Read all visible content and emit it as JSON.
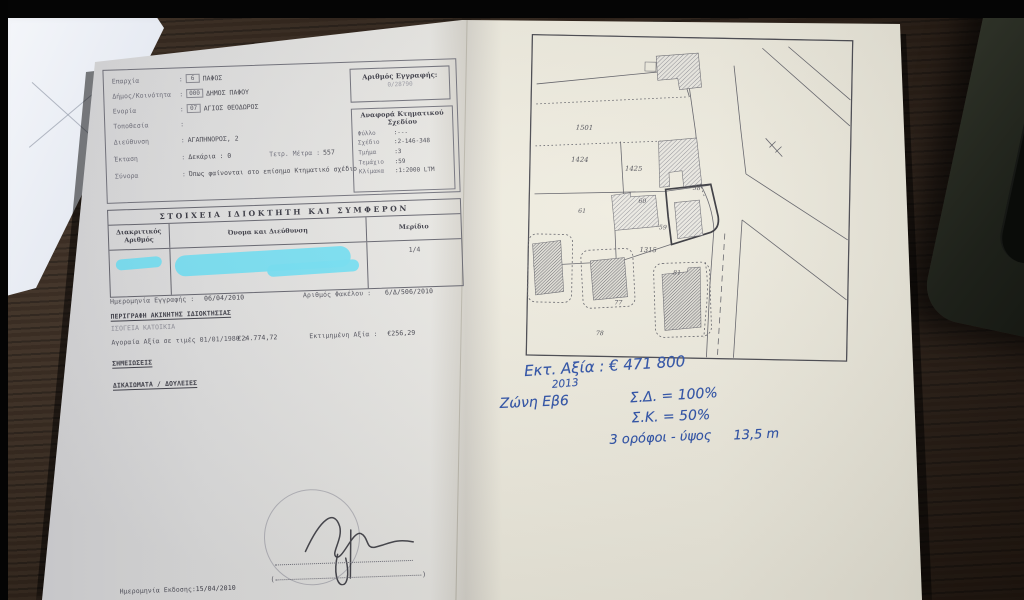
{
  "form": {
    "fields": [
      {
        "label": "Επαρχία",
        "sep": ":",
        "code": "6",
        "value": "ΠΑΦΟΣ"
      },
      {
        "label": "Δήμος/Κοινότητα",
        "sep": ":",
        "code": "000",
        "value": "ΔΗΜΟΣ ΠΑΦΟΥ"
      },
      {
        "label": "Ενορία",
        "sep": ":",
        "code": "07",
        "value": "ΑΓΙΟΣ ΘΕΟΔΩΡΟΣ"
      },
      {
        "label": "Τοποθεσία",
        "sep": ":",
        "code": "",
        "value": ""
      },
      {
        "label": "Διεύθυνση",
        "sep": ":",
        "code": "",
        "value": "ΑΓΑΠΗΝΟΡΟΣ, 2"
      },
      {
        "label": "Έκταση",
        "sep": ":",
        "code": "",
        "value": "Δεκάρια : 0",
        "extra_label": "Τετρ. Μέτρα :",
        "extra_value": "557"
      },
      {
        "label": "Σύνορα",
        "sep": ":",
        "code": "",
        "value": "Όπως φαίνονται στο επίσημο Κτηματικό σχέδιο"
      }
    ],
    "registration_box": {
      "title": "Αριθμός Εγγραφής:",
      "number": "0/28790"
    },
    "plan_box": {
      "title": "Αναφορά Κτηματικού Σχεδίου",
      "rows": [
        {
          "label": "Φύλλο",
          "value": ":---"
        },
        {
          "label": "Σχέδιο",
          "value": ":2-146-348"
        },
        {
          "label": "Τμήμα",
          "value": ":3"
        },
        {
          "label": "Τεμάχιο",
          "value": ":59"
        },
        {
          "label": "Κλίμακα",
          "value": ":1:2000 LTM"
        }
      ]
    }
  },
  "owners_table": {
    "title": "ΣΤΟΙΧΕΙΑ ΙΔΙΟΚΤΗΤΗ ΚΑΙ ΣΥΜΦΕΡΟΝ",
    "columns": [
      "Διακριτικός Αριθμός",
      "Όνομα και Διεύθυνση",
      "Μερίδιο"
    ],
    "row": {
      "share": "1/4"
    }
  },
  "details": {
    "registration_date_label": "Ημερομηνία Εγγραφής :",
    "registration_date": "06/04/2010",
    "file_number_label": "Αριθμός Φακέλου :",
    "file_number": "6/Δ/506/2010",
    "description_heading": "ΠΕΡΙΓΡΑΦΗ ΑΚΙΝΗΤΗΣ ΙΔΙΟΚΤΗΣΙΑΣ",
    "description_value": "ΙΣΟΓΕΙΑ ΚΑΤΟΙΚΙΑ",
    "market_value_label": "Αγοραία Αξία σε τιμές 01/01/1980 :",
    "market_value": "€24.774,72",
    "estimated_value_label": "Εκτιμημένη Αξία :",
    "estimated_value": "€256,29",
    "notes_heading": "ΣΗΜΕΙΩΣΕΙΣ",
    "rights_heading": "ΔΙΚΑΙΩΜΑΤΑ / ΔΟΥΛΕΙΕΣ"
  },
  "footer": {
    "issue_date_label": "Ημερομηνία Εκδοσης:",
    "issue_date": "15/04/2010",
    "paren_open": "(",
    "paren_close": ")"
  },
  "map": {
    "parcels": [
      "1501",
      "1424",
      "1425",
      "61",
      "60",
      "58",
      "59",
      "1315",
      "81",
      "77",
      "78"
    ]
  },
  "handwriting": {
    "estimate": "Εκτ. Αξία : € 471 800",
    "year": "2013",
    "zone": "Ζώνη Εβ6",
    "density": "Σ.Δ. = 100%",
    "coverage": "Σ.Κ. = 50%",
    "floors": "3 ορόφοι - ύψος",
    "height": "13,5 m"
  }
}
